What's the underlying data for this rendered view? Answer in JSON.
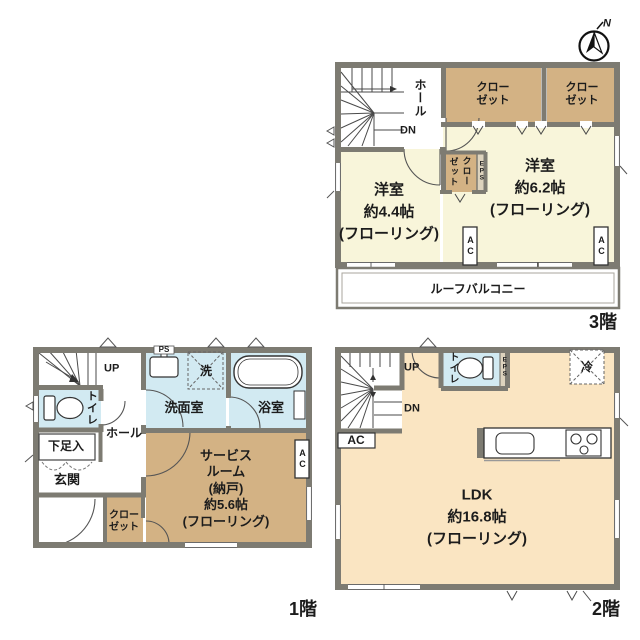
{
  "palette": {
    "wall": "#7d7b72",
    "room_cream": "#f8f5da",
    "room_peach": "#fae5c2",
    "room_tan": "#d3b284",
    "room_blue": "#d2eaf2",
    "shaft_tan": "#ddd3bd",
    "line_dark": "#3a3a3a",
    "text": "#1c1c1c"
  },
  "compass": {
    "north_label": "N"
  },
  "floor3": {
    "floor_label": "3階",
    "hall": "ホール",
    "stairs_dn": "DN",
    "closet_right1": [
      "クロー",
      "ゼット"
    ],
    "closet_right2": [
      "クロー",
      "ゼット"
    ],
    "room_62": [
      "洋室",
      "約6.2帖",
      "(フローリング)"
    ],
    "room_44": [
      "洋室",
      "約4.4帖",
      "(フローリング)"
    ],
    "closet_small": [
      "クロー",
      "ゼット"
    ],
    "eps": "EPS",
    "ac1": "AC",
    "ac2": "AC",
    "balcony": "ルーフバルコニー"
  },
  "floor1": {
    "floor_label": "1階",
    "stairs_up": "UP",
    "toilet": "トイレ",
    "hall": "ホール",
    "shoe_box": "下足入",
    "entrance": "玄関",
    "ps": "PS",
    "washroom": "洗面室",
    "laundry": "洗",
    "bathroom": "浴室",
    "service_room": [
      "サービス",
      "ルーム",
      "(納戸)",
      "約5.6帖",
      "(フローリング)"
    ],
    "ac": "AC",
    "closet": [
      "クロー",
      "ゼット"
    ]
  },
  "floor2": {
    "floor_label": "2階",
    "stairs_up": "UP",
    "stairs_dn": "DN",
    "toilet": "トイレ",
    "eps": "EPS",
    "refrigerator": "冷",
    "ac": "AC",
    "ldk": [
      "LDK",
      "約16.8帖",
      "(フローリング)"
    ]
  }
}
